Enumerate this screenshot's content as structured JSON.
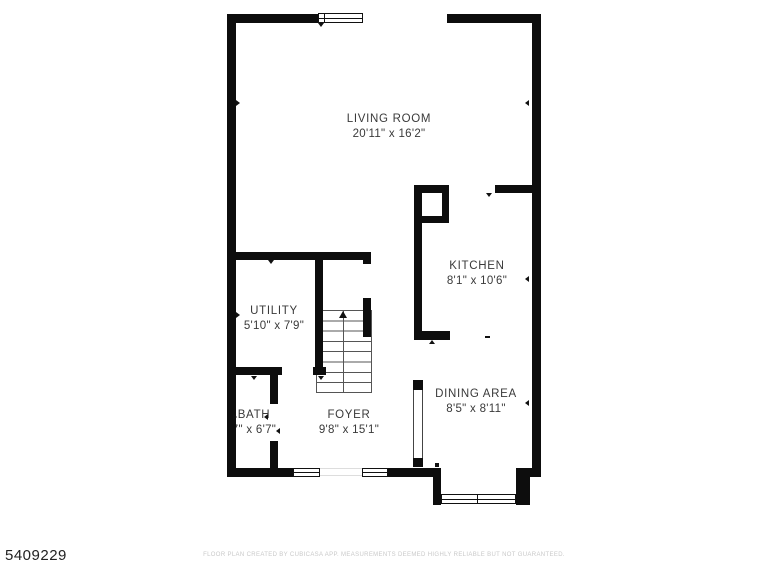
{
  "meta": {
    "listing_id": "5409229"
  },
  "rooms": [
    {
      "id": "living-room",
      "name": "LIVING ROOM",
      "dims": "20'11\" x 16'2\""
    },
    {
      "id": "kitchen",
      "name": "KITCHEN",
      "dims": "8'1\" x 10'6\""
    },
    {
      "id": "utility",
      "name": "UTILITY",
      "dims": "5'10\" x 7'9\""
    },
    {
      "id": "bath",
      "name": "BATH",
      "dims": "7\" x 6'7\""
    },
    {
      "id": "foyer",
      "name": "FOYER",
      "dims": "9'8\" x 15'1\""
    },
    {
      "id": "dining-area",
      "name": "DINING AREA",
      "dims": "8'5\" x 8'11\""
    }
  ],
  "footer": {
    "disclaimer": "FLOOR PLAN CREATED BY CUBICASA APP. MEASUREMENTS DEEMED HIGHLY RELIABLE BUT NOT GUARANTEED."
  },
  "colors": {
    "wall": "#0d0d0d",
    "room_text": "#3a3a3a",
    "disclaimer_text": "#c9c9c9",
    "background": "#ffffff"
  }
}
